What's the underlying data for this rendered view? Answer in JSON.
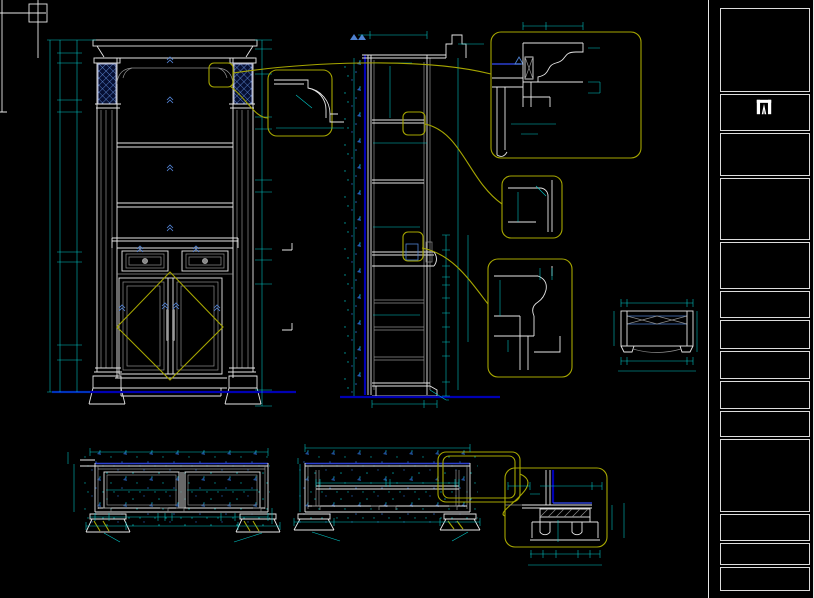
{
  "window": {
    "width": 814,
    "height": 598,
    "background": "#000000"
  },
  "colors": {
    "dimension": "#00caca",
    "geometry": "#e6e6e6",
    "callout": "#a6a600",
    "deep_blue": "#0000b4",
    "bright_blue": "#2a3fd0",
    "hatch_blue": "#4f81d0"
  },
  "title_block": {
    "sheet_title": "标准图",
    "logo_text": "图森木作",
    "logo_sub": "TUCSON WOOD",
    "company": "图森木业有限公司",
    "address": "浙江省嵊州市兴盛街1#号",
    "phone": "0575-83000633",
    "project_label": "工程名称:",
    "project_value": "柜类",
    "product_label": "产品名称:",
    "product_value": "9#装饰柜",
    "measure_label": "测量:",
    "draft_label": "制图:",
    "draft_value": "唐晓丽",
    "review_label": "审核:",
    "review_value": "韩李有",
    "approve_label": "批准:",
    "approve_value": "陈炎飞",
    "version_label": "版本号: A",
    "owner_label": "业主确认:",
    "scale_label": "比例:",
    "drawing_no_label": "图号:",
    "page_info": "第20页,共 57 页"
  },
  "drawings": {
    "elevation_label": "立面图",
    "section_label": "竖剖图",
    "aa_section_label": "A-A横剖图",
    "bb_section_label": "B-B横剖图",
    "carving_section_label": "雕花横剖图",
    "back_panel_note": "背板采用5厘覆膜板"
  },
  "section_markers": [
    {
      "x": 296,
      "y": 252,
      "t": "A"
    },
    {
      "x": 296,
      "y": 332,
      "t": "B"
    }
  ],
  "dim_labels": [
    [
      66,
      47,
      "25",
      -90
    ],
    [
      66,
      58,
      "85",
      -90
    ],
    [
      72,
      85,
      "500",
      -90
    ],
    [
      66,
      106,
      "36",
      -90
    ],
    [
      72,
      185,
      "904",
      -90
    ],
    [
      66,
      257,
      "30",
      -90
    ],
    [
      72,
      312,
      "625",
      -90
    ],
    [
      66,
      352,
      "95",
      -90
    ],
    [
      72,
      378,
      "219",
      -90
    ],
    [
      52,
      218,
      "2348",
      -90
    ],
    [
      266,
      45,
      "60",
      -90
    ],
    [
      266,
      62,
      "171",
      -90
    ],
    [
      266,
      96,
      "287",
      -90
    ],
    [
      266,
      123,
      "80",
      -90
    ],
    [
      266,
      155,
      "347",
      -90
    ],
    [
      266,
      186,
      "80",
      -90
    ],
    [
      266,
      221,
      "387",
      -90
    ],
    [
      266,
      255,
      "70",
      -90
    ],
    [
      273,
      263,
      "9"
    ],
    [
      266,
      273,
      "147",
      -90
    ],
    [
      273,
      285,
      "9"
    ],
    [
      266,
      337,
      "714",
      -90
    ],
    [
      273,
      384,
      "9"
    ],
    [
      266,
      399,
      "100",
      -90
    ],
    [
      352,
      29,
      "9"
    ],
    [
      398,
      32,
      "298"
    ],
    [
      471,
      41,
      "60"
    ],
    [
      396,
      61,
      "252"
    ],
    [
      390,
      92,
      "465",
      -90
    ],
    [
      394,
      141,
      "270"
    ],
    [
      421,
      141,
      "14"
    ],
    [
      354,
      152,
      "1370",
      -90
    ],
    [
      460,
      152,
      "1281",
      -90
    ],
    [
      398,
      225,
      "190"
    ],
    [
      394,
      313,
      "290"
    ],
    [
      455,
      243,
      "70",
      -90
    ],
    [
      455,
      261,
      "142",
      -90
    ],
    [
      451,
      277,
      "18",
      -90
    ],
    [
      441,
      291,
      "164",
      -90
    ],
    [
      451,
      306,
      "18",
      -90
    ],
    [
      441,
      321,
      "164",
      -90
    ],
    [
      451,
      335,
      "18",
      -90
    ],
    [
      441,
      350,
      "164",
      -90
    ],
    [
      441,
      371,
      "144",
      -90
    ],
    [
      441,
      391,
      "100",
      -90
    ],
    [
      469,
      328,
      "710",
      -90
    ],
    [
      395,
      407,
      "238"
    ],
    [
      429,
      407,
      "84"
    ],
    [
      311,
      88,
      "18",
      -90
    ],
    [
      285,
      108,
      "50",
      -90
    ],
    [
      283,
      129,
      "14"
    ],
    [
      304,
      112,
      "R50",
      40
    ],
    [
      300,
      146,
      "60"
    ],
    [
      330,
      146,
      "10"
    ],
    [
      340,
      146,
      "10"
    ],
    [
      534,
      26,
      "40"
    ],
    [
      567,
      26,
      "65"
    ],
    [
      595,
      67,
      "60",
      -90
    ],
    [
      607,
      87,
      "10"
    ],
    [
      595,
      100,
      "10"
    ],
    [
      495,
      82,
      "15",
      -90
    ],
    [
      495,
      121,
      "110",
      -90
    ],
    [
      514,
      128,
      "18"
    ],
    [
      542,
      128,
      "66"
    ],
    [
      529,
      140,
      "10"
    ],
    [
      568,
      95,
      "25",
      35
    ],
    [
      512,
      208,
      "60",
      -90
    ],
    [
      548,
      212,
      "11"
    ],
    [
      546,
      190,
      "45",
      40
    ],
    [
      556,
      268,
      "30"
    ],
    [
      514,
      308,
      "70",
      -90
    ],
    [
      502,
      328,
      "5"
    ],
    [
      514,
      352,
      "35",
      -90
    ],
    [
      541,
      342,
      "16"
    ],
    [
      560,
      343,
      "35",
      -90
    ],
    [
      560,
      358,
      "25",
      -90
    ],
    [
      627,
      299,
      "18"
    ],
    [
      656,
      299,
      "84"
    ],
    [
      686,
      299,
      "18"
    ],
    [
      609,
      328,
      "45",
      -90
    ],
    [
      609,
      343,
      "9"
    ],
    [
      701,
      329,
      "55",
      -90
    ],
    [
      627,
      357,
      "16"
    ],
    [
      657,
      357,
      "88"
    ],
    [
      687,
      357,
      "16"
    ],
    [
      657,
      368,
      "120"
    ],
    [
      181,
      448,
      "704"
    ],
    [
      70,
      459,
      "20",
      -90
    ],
    [
      86,
      489,
      "320",
      -90
    ],
    [
      136,
      488,
      "313"
    ],
    [
      156,
      489,
      "25",
      -90
    ],
    [
      198,
      488,
      "313"
    ],
    [
      209,
      489,
      "25",
      -90
    ],
    [
      123,
      520,
      "50"
    ],
    [
      148,
      520,
      "243"
    ],
    [
      167,
      516,
      "20"
    ],
    [
      174,
      521,
      "50"
    ],
    [
      199,
      520,
      "243"
    ],
    [
      222,
      520,
      "50"
    ],
    [
      104,
      529,
      "120"
    ],
    [
      176,
      529,
      "645"
    ],
    [
      234,
      529,
      "120"
    ],
    [
      123,
      544,
      "36"
    ],
    [
      232,
      544,
      "36"
    ],
    [
      257,
      516,
      "23",
      -90
    ],
    [
      358,
      444,
      "704"
    ],
    [
      297,
      465,
      "4"
    ],
    [
      304,
      487,
      "320",
      -90
    ],
    [
      338,
      486,
      "3"
    ],
    [
      359,
      486,
      "343"
    ],
    [
      388,
      486,
      "3"
    ],
    [
      414,
      486,
      "343"
    ],
    [
      437,
      488,
      "3"
    ],
    [
      427,
      483,
      "35",
      -90
    ],
    [
      334,
      529,
      "120"
    ],
    [
      386,
      529,
      "605"
    ],
    [
      451,
      528,
      "120"
    ],
    [
      339,
      542,
      "30"
    ],
    [
      449,
      542,
      "30"
    ],
    [
      519,
      483,
      "30"
    ],
    [
      534,
      491,
      "18"
    ],
    [
      566,
      483,
      "84"
    ],
    [
      597,
      483,
      "18"
    ],
    [
      613,
      518,
      "40",
      -90
    ],
    [
      625,
      521,
      "65",
      -90
    ],
    [
      563,
      526,
      "18",
      -90
    ],
    [
      563,
      538,
      "16",
      -90
    ],
    [
      538,
      551,
      "20"
    ],
    [
      549,
      551,
      "23"
    ],
    [
      568,
      551,
      "34"
    ],
    [
      584,
      551,
      "23"
    ],
    [
      598,
      551,
      "20"
    ],
    [
      566,
      562,
      "120"
    ]
  ]
}
